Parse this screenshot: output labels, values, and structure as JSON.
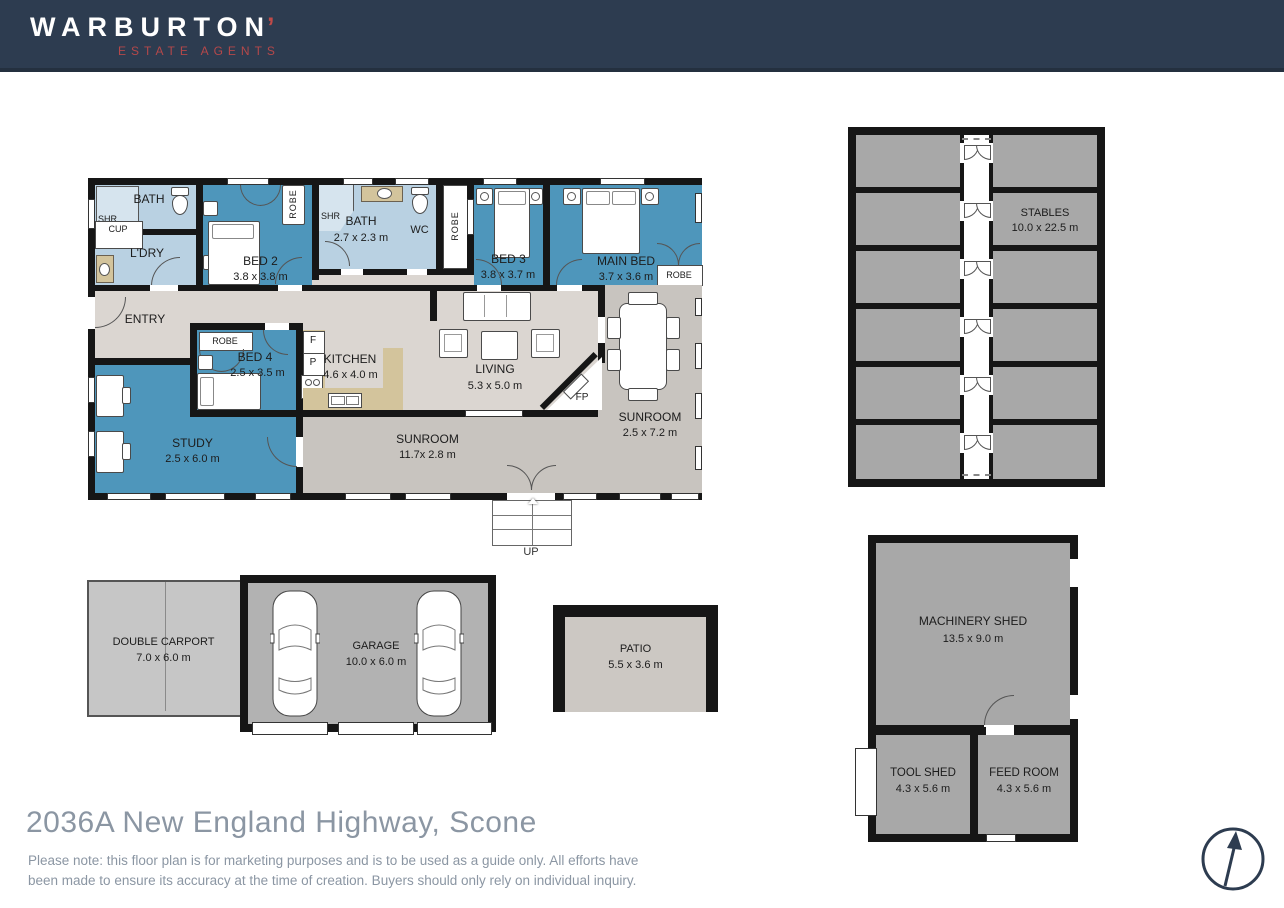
{
  "header": {
    "brand": "WARBURTON",
    "brand_mark": "’",
    "tagline": "ESTATE AGENTS"
  },
  "house": {
    "bath_top": {
      "name": "BATH",
      "shower": "SHR",
      "cupboard": "CUP"
    },
    "laundry": {
      "name": "L'DRY"
    },
    "bed2": {
      "name": "BED 2",
      "dims": "3.8 x 3.8 m",
      "robe": "ROBE"
    },
    "bath_main": {
      "name": "BATH",
      "dims": "2.7 x 2.3 m",
      "shower": "SHR"
    },
    "wc": {
      "name": "WC"
    },
    "hall_robe": {
      "name": "ROBE"
    },
    "bed3": {
      "name": "BED 3",
      "dims": "3.8 x 3.7 m"
    },
    "main_bed": {
      "name": "MAIN BED",
      "dims": "3.7 x 3.6 m",
      "robe": "ROBE"
    },
    "entry": {
      "name": "ENTRY"
    },
    "bed4": {
      "name": "BED 4",
      "dims": "2.5 x 3.5 m",
      "robe": "ROBE"
    },
    "kitchen": {
      "name": "KITCHEN",
      "dims": "4.6 x 4.0 m",
      "fridge": "F",
      "pantry": "P"
    },
    "living": {
      "name": "LIVING",
      "dims": "5.3 x 5.0 m",
      "fireplace": "FP"
    },
    "sunroom_east": {
      "name": "SUNROOM",
      "dims": "2.5 x 7.2 m"
    },
    "sunroom_south": {
      "name": "SUNROOM",
      "dims": "11.7x 2.8 m"
    },
    "study": {
      "name": "STUDY",
      "dims": "2.5 x 6.0 m"
    },
    "stairs": {
      "label": "UP"
    }
  },
  "outbuildings": {
    "stables": {
      "name": "STABLES",
      "dims": "10.0 x 22.5 m"
    },
    "carport": {
      "name": "DOUBLE CARPORT",
      "dims": "7.0 x 6.0 m"
    },
    "garage": {
      "name": "GARAGE",
      "dims": "10.0 x 6.0 m"
    },
    "patio": {
      "name": "PATIO",
      "dims": "5.5 x 3.6 m"
    },
    "machinery_shed": {
      "name": "MACHINERY SHED",
      "dims": "13.5 x 9.0 m"
    },
    "tool_shed": {
      "name": "TOOL SHED",
      "dims": "4.3 x 5.6 m"
    },
    "feed_room": {
      "name": "FEED ROOM",
      "dims": "4.3 x 5.6 m"
    }
  },
  "footer": {
    "address": "2036A New England Highway, Scone",
    "disclaimer": "Please note: this floor plan is for marketing purposes and is to be used as a guide only. All efforts have\nbeen made to ensure its accuracy at the time of creation. Buyers should only rely on individual inquiry."
  },
  "colors": {
    "header_navy": "#2d3c50",
    "brand_red": "#b5484a",
    "room_teal": "#4e96bb",
    "room_lightblue": "#b9d1e2",
    "floor_beige": "#dbd6d1",
    "sunroom_gray": "#c8c4bf",
    "stall_gray": "#a8a8a8",
    "counter_tan": "#d3c49c",
    "wall_black": "#161616",
    "text_gray": "#8b96a3"
  }
}
